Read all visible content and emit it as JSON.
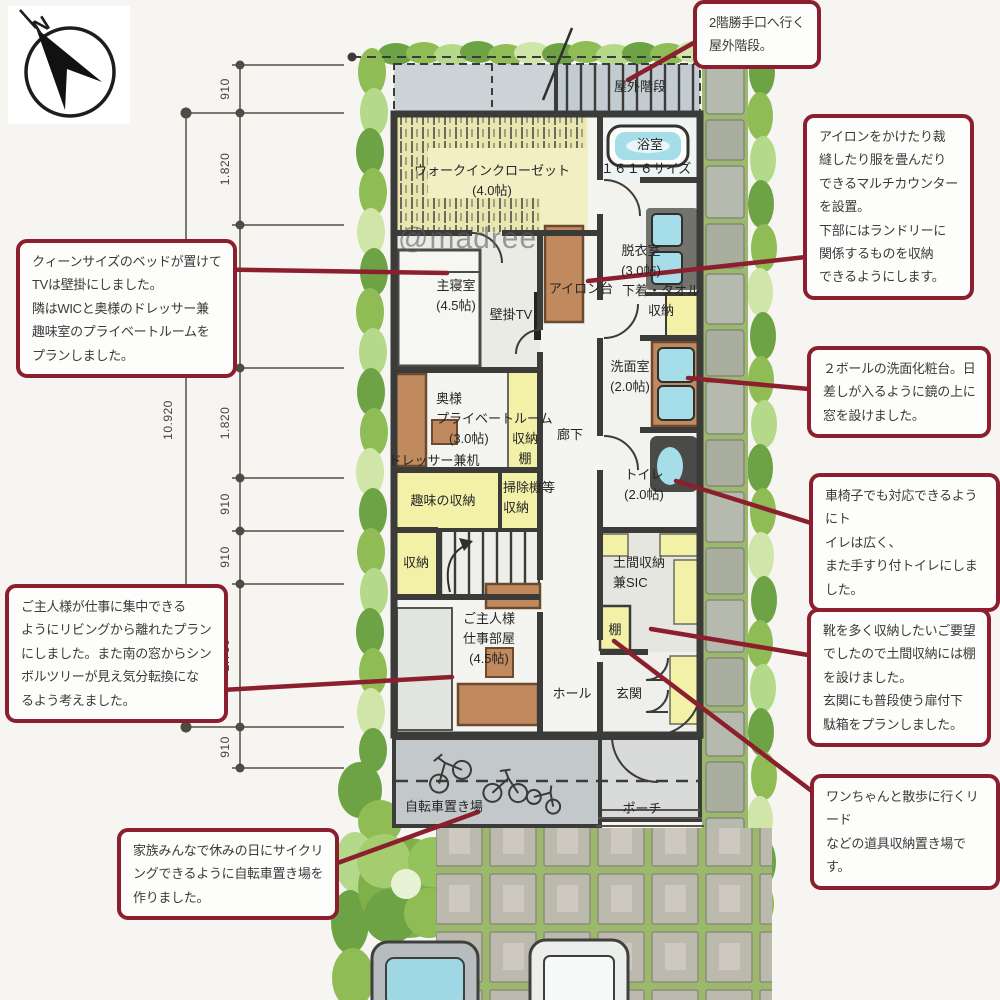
{
  "watermark": "@madree",
  "compass": {
    "north_label": "N"
  },
  "dimensions": {
    "overall": "10.920",
    "segments": [
      "910",
      "1.820",
      "2.730",
      "1.820",
      "910",
      "910",
      "2.730",
      "910"
    ]
  },
  "rooms": {
    "outdoor_stairs": "屋外階段",
    "bath": "浴室",
    "bath_size": "１６１６サイズ",
    "wic": "ウォークインクローゼット\n(4.0帖)",
    "dressing_room": "脱衣室\n(3.0帖)",
    "iron_counter": "アイロン台",
    "master_bedroom": "主寝室\n(4.5帖)",
    "wall_tv": "壁掛TV",
    "underwear_storage": "下着・タオル\n収納",
    "washroom": "洗面室\n(2.0帖)",
    "wife_private_room": "奥様\nプライベートルーム\n　(3.0帖)",
    "dresser_desk": "ドレッサー兼机",
    "storage_shelf": "収納\n棚",
    "hallway": "廊下",
    "toilet": "トイレ\n(2.0帖)",
    "hobby_storage": "趣味の収納",
    "vacuum_storage": "掃除機等\n収納",
    "closet": "収納",
    "doma_storage": "土間収納\n兼SIC",
    "shelf": "棚",
    "husband_workroom": "ご主人様\n仕事部屋\n(4.5帖)",
    "hall": "ホール",
    "entrance": "玄関",
    "bicycle_parking": "自転車置き場",
    "porch": "ポーチ"
  },
  "annotations": {
    "outdoor_stairs_note": "2階勝手口へ行く\n屋外階段。",
    "multi_counter_note": "アイロンをかけたり裁\n縫したり服を畳んだり\nできるマルチカウンター\nを設置。\n下部にはランドリーに\n関係するものを収納\nできるようにします。",
    "wash_basin_note": "２ボールの洗面化粧台。日\n差しが入るように鏡の上に\n窓を設けました。",
    "toilet_note": "車椅子でも対応できるようにト\nイレは広く、\nまた手すり付トイレにしました。",
    "shoe_storage_note": "靴を多く収納したいご要望\nでしたので土間収納には棚\nを設けました。\n玄関にも普段使う扉付下\n駄箱をプランしました。",
    "dog_lead_note": "ワンちゃんと散歩に行くリード\nなどの道具収納置き場で\nす。",
    "bedroom_note": "クィーンサイズのベッドが置けて\nTVは壁掛にしました。\n隣はWICと奥様のドレッサー兼\n趣味室のプライベートルームを\nプランしました。",
    "workroom_note": "ご主人様が仕事に集中できる\nようにリビングから離れたプラン\nにしました。また南の窓からシン\nボルツリーが見え気分転換にな\nるよう考えました。",
    "bicycle_note": "家族みんなで休みの日にサイクリ\nングできるように自転車置き場を\n作りました。"
  },
  "colors": {
    "annotation_red": "#8c1f2e",
    "wall_dark": "#3b3b39",
    "tatami_yellow": "#f3f0a8",
    "wood_brown": "#c18a5e",
    "water_blue": "#a5dde8",
    "hedge_green": "#8fbc55"
  }
}
